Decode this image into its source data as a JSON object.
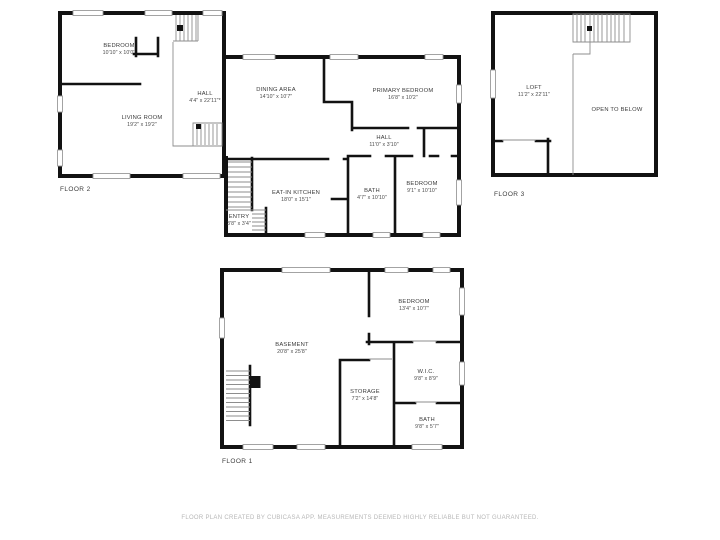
{
  "colors": {
    "wall": "#121212",
    "label": "#3b3b3b",
    "window": "#9a9a9a",
    "footer_text": "#b7b7b7",
    "background": "#ffffff"
  },
  "footer": {
    "text": "FLOOR PLAN CREATED BY CUBICASA APP. MEASUREMENTS DEEMED HIGHLY RELIABLE BUT NOT GUARANTEED."
  },
  "floors": {
    "floor2": {
      "label": "FLOOR 2",
      "rooms": {
        "bedroom": {
          "name": "BEDROOM",
          "dims": "10'10\" x 10'0\""
        },
        "living_room": {
          "name": "LIVING ROOM",
          "dims": "19'2\" x 19'2\""
        },
        "hall": {
          "name": "HALL",
          "dims": "4'4\" x 22'11\"*"
        },
        "dining_area": {
          "name": "DINING AREA",
          "dims": "14'10\" x 10'7\""
        },
        "primary_bedroom": {
          "name": "PRIMARY BEDROOM",
          "dims": "16'8\" x 10'2\""
        },
        "hall2": {
          "name": "HALL",
          "dims": "11'0\" x 3'10\""
        },
        "bath": {
          "name": "BATH",
          "dims": "4'7\" x 10'10\""
        },
        "bedroom2": {
          "name": "BEDROOM",
          "dims": "9'1\" x 10'10\""
        },
        "eat_in_kitchen": {
          "name": "EAT-IN KITCHEN",
          "dims": "18'0\" x 15'1\""
        },
        "entry": {
          "name": "ENTRY",
          "dims": "3'8\" x 3'4\""
        }
      }
    },
    "floor3": {
      "label": "FLOOR 3",
      "rooms": {
        "loft": {
          "name": "LOFT",
          "dims": "11'2\" x 22'11\""
        },
        "open_to_below": {
          "name": "OPEN TO BELOW"
        }
      }
    },
    "floor1": {
      "label": "FLOOR 1",
      "rooms": {
        "basement": {
          "name": "BASEMENT",
          "dims": "20'8\" x 25'8\""
        },
        "bedroom": {
          "name": "BEDROOM",
          "dims": "13'4\" x 10'7\""
        },
        "storage": {
          "name": "STORAGE",
          "dims": "7'2\" x 14'8\""
        },
        "wic": {
          "name": "W.I.C.",
          "dims": "9'8\" x 8'9\""
        },
        "bath": {
          "name": "BATH",
          "dims": "9'8\" x 5'7\""
        }
      }
    }
  }
}
